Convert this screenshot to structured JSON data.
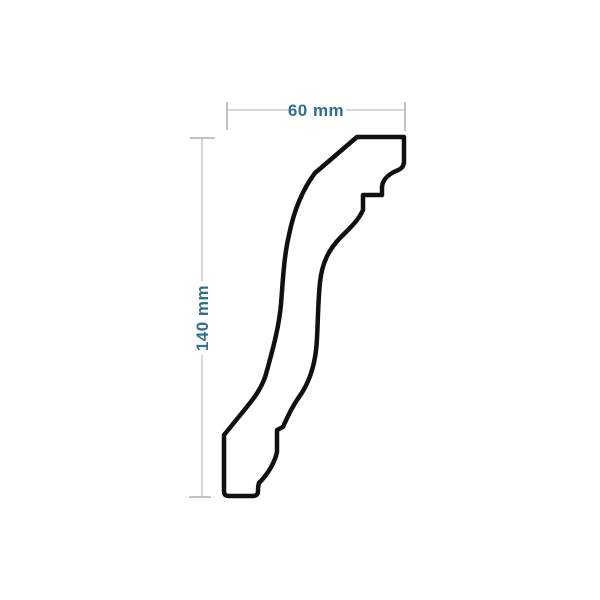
{
  "diagram": {
    "kind": "molding-profile-cross-section",
    "dimensions": {
      "width": {
        "label": "60 mm",
        "value_mm": 60
      },
      "height": {
        "label": "140 mm",
        "value_mm": 140
      }
    },
    "colors": {
      "background": "#ffffff",
      "profile_outline": "#101010",
      "profile_fill": "#ffffff",
      "dimension_line": "#c9c9c9",
      "dimension_tick": "#aeaeae",
      "dimension_text": "#2e6e91"
    },
    "profile": {
      "path": "M 357 137 L 404 137 L 404 161 C 404 167 401 169 396 171 C 387 175 382 181 382 188 L 382 195 L 363 195 L 363 210 C 358 221 350 228 341 237 C 328 250 322 264 320 282 C 318 302 318 320 317 338 C 316 362 310 382 299 397 C 292 407 286 420 283 427 L 277 430 L 277 452 C 275 462 268 474 259 483 C 258 486 258 488 258 491 C 258 495 256 496 252 496 L 229 496 C 226 496 224 495 224 491 L 224 435 L 246 408 C 254 398 262 388 266 374 C 272 352 279 328 281 304 C 283 279 284 256 289 235 C 293 215 300 193 315 173 L 357 137 Z"
    }
  }
}
